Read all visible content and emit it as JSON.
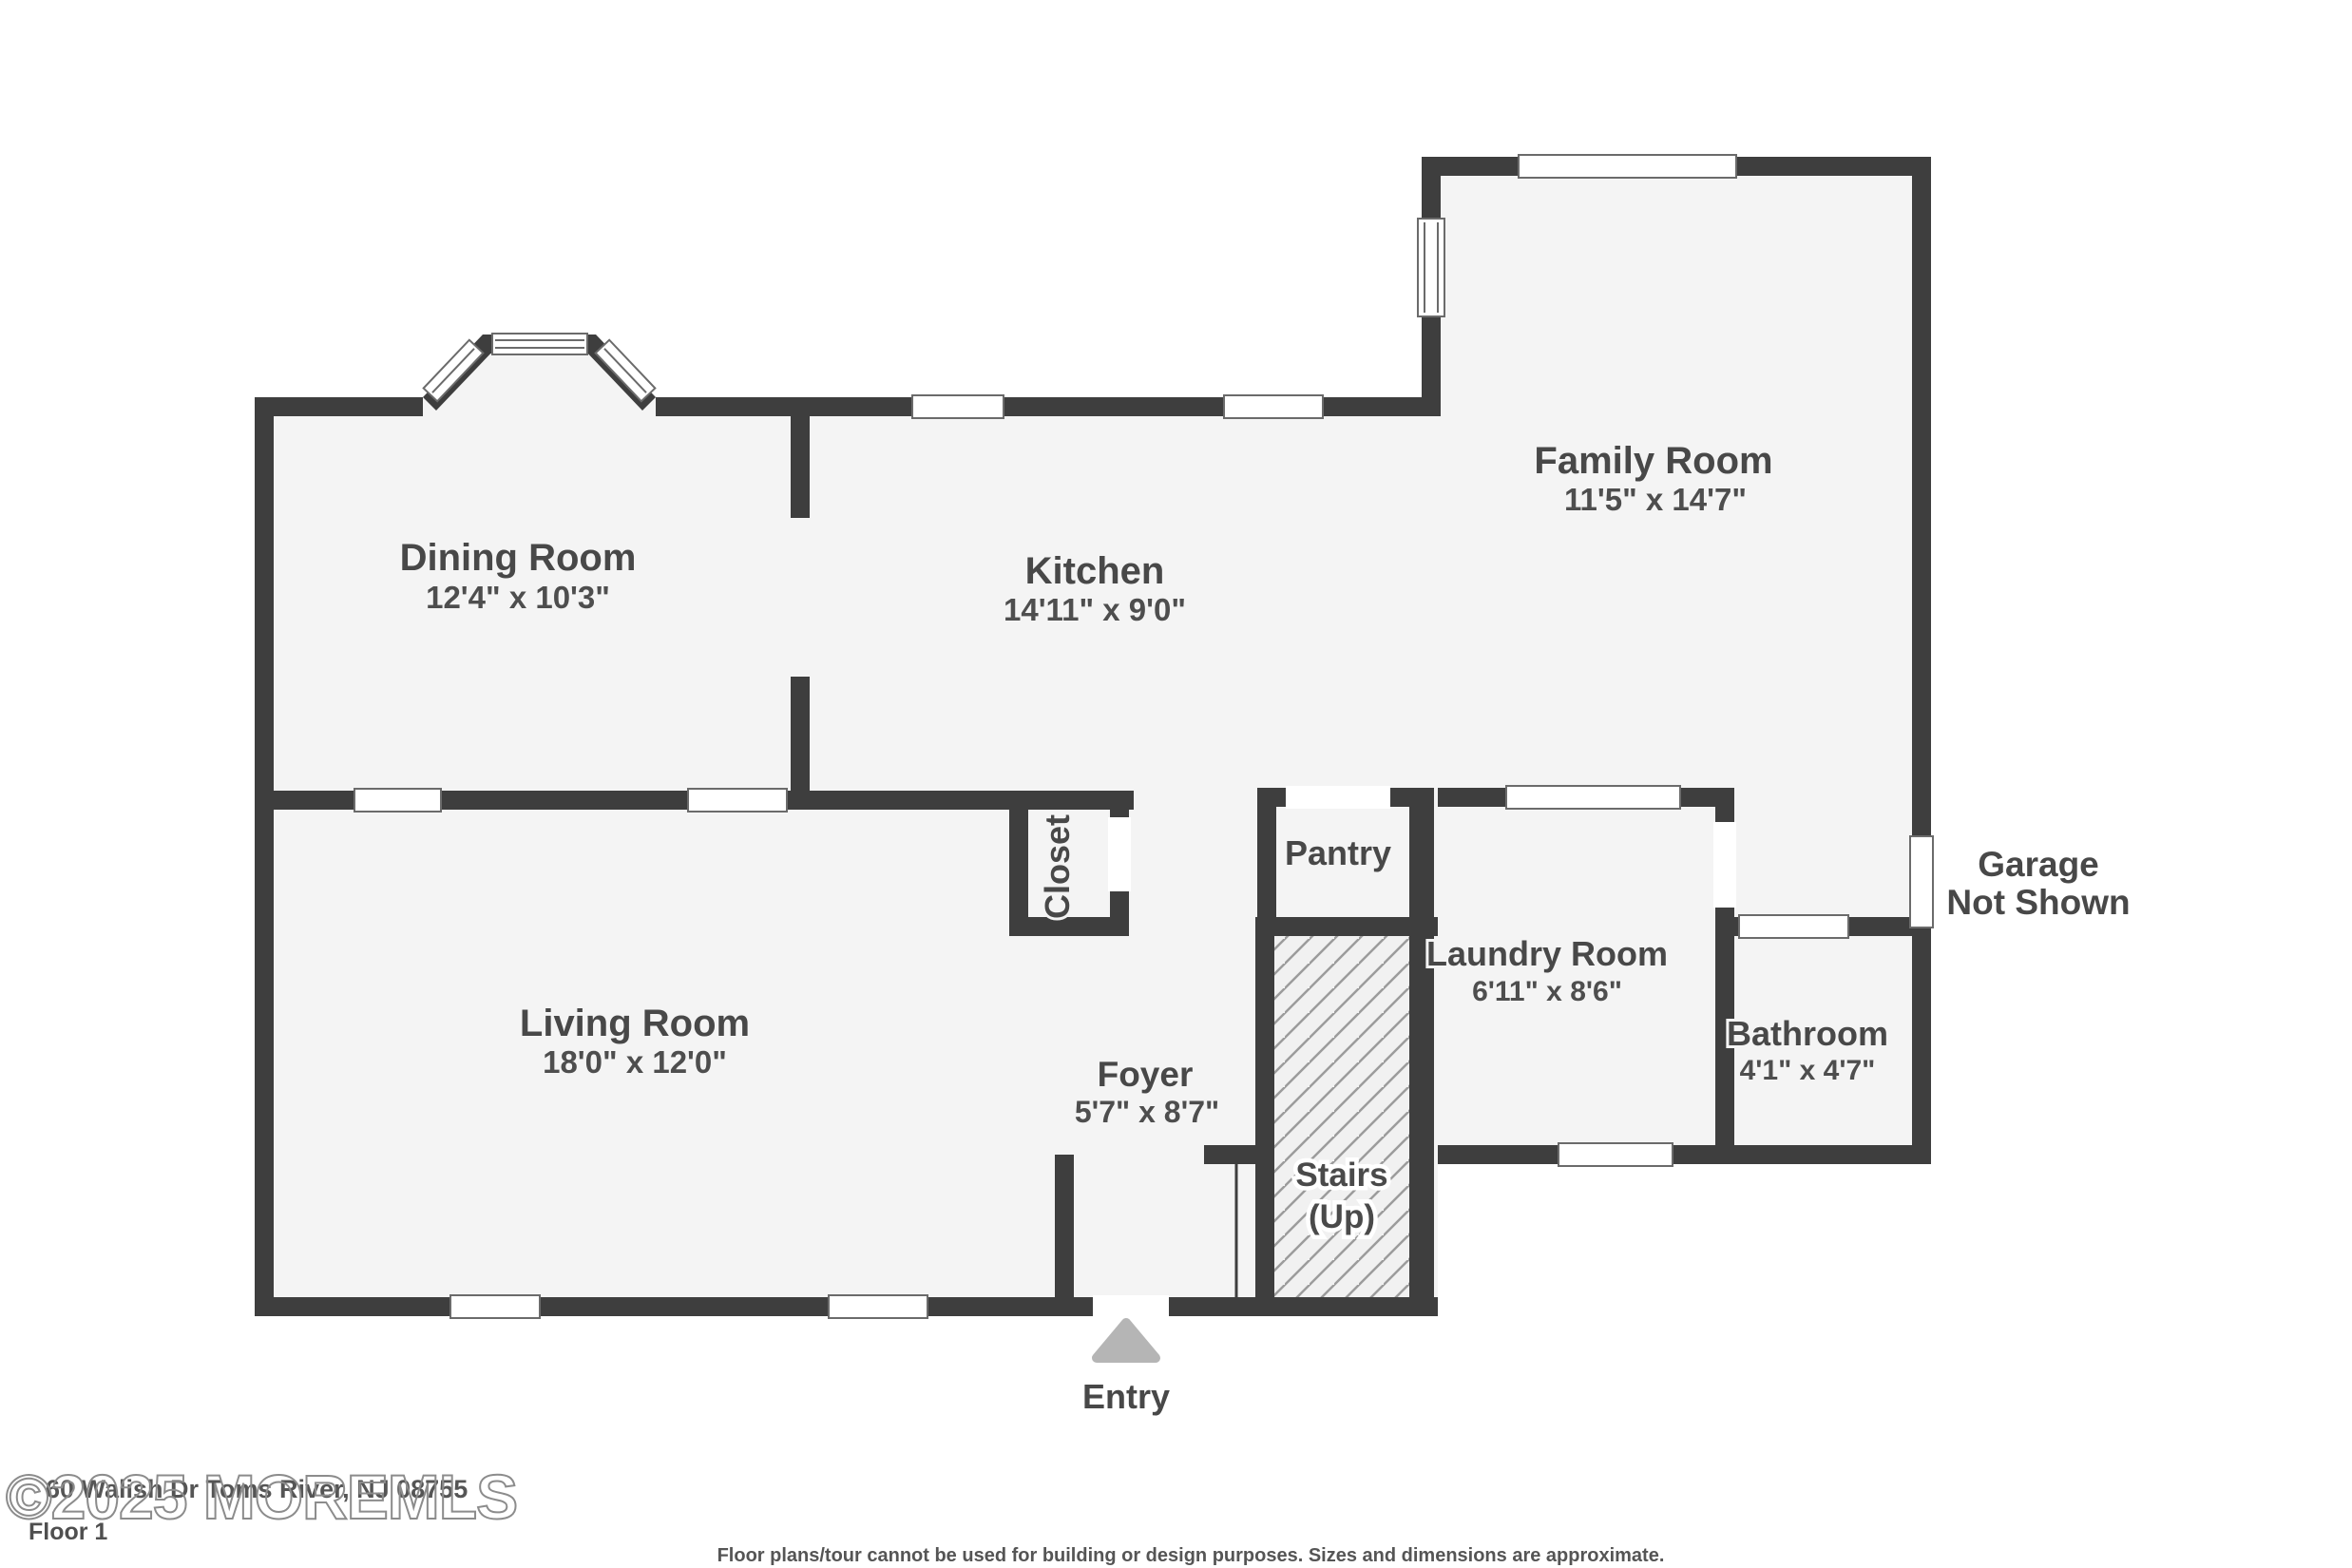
{
  "floor_plan": {
    "floor_label": "Floor 1",
    "watermark": "©2025 MOREMLS",
    "address": "60 Walish Dr Toms River, NJ 08755",
    "disclaimer": "Floor plans/tour cannot be used for building or design purposes. Sizes and dimensions are approximate.",
    "entry_label": "Entry",
    "garage_note": {
      "line1": "Garage",
      "line2": "Not Shown"
    },
    "stairs": {
      "line1": "Stairs",
      "line2": "(Up)"
    },
    "rooms": {
      "dining": {
        "name": "Dining Room",
        "dims": "12'4\" x 10'3\""
      },
      "kitchen": {
        "name": "Kitchen",
        "dims": "14'11\" x 9'0\""
      },
      "family": {
        "name": "Family Room",
        "dims": "11'5\" x 14'7\""
      },
      "living": {
        "name": "Living Room",
        "dims": "18'0\" x 12'0\""
      },
      "laundry": {
        "name": "Laundry Room",
        "dims": "6'11\" x 8'6\""
      },
      "bathroom": {
        "name": "Bathroom",
        "dims": "4'1\" x 4'7\""
      },
      "foyer": {
        "name": "Foyer",
        "dims": "5'7\" x 8'7\""
      },
      "closet": {
        "name": "Closet"
      },
      "pantry": {
        "name": "Pantry"
      }
    },
    "colors": {
      "wall": "#3e3e3e",
      "floor": "#f4f4f4",
      "hatch_line": "#9c9c9c",
      "label": "#484848",
      "entry_triangle": "#b5b5b5",
      "window_frame": "#6b6b6b"
    }
  }
}
